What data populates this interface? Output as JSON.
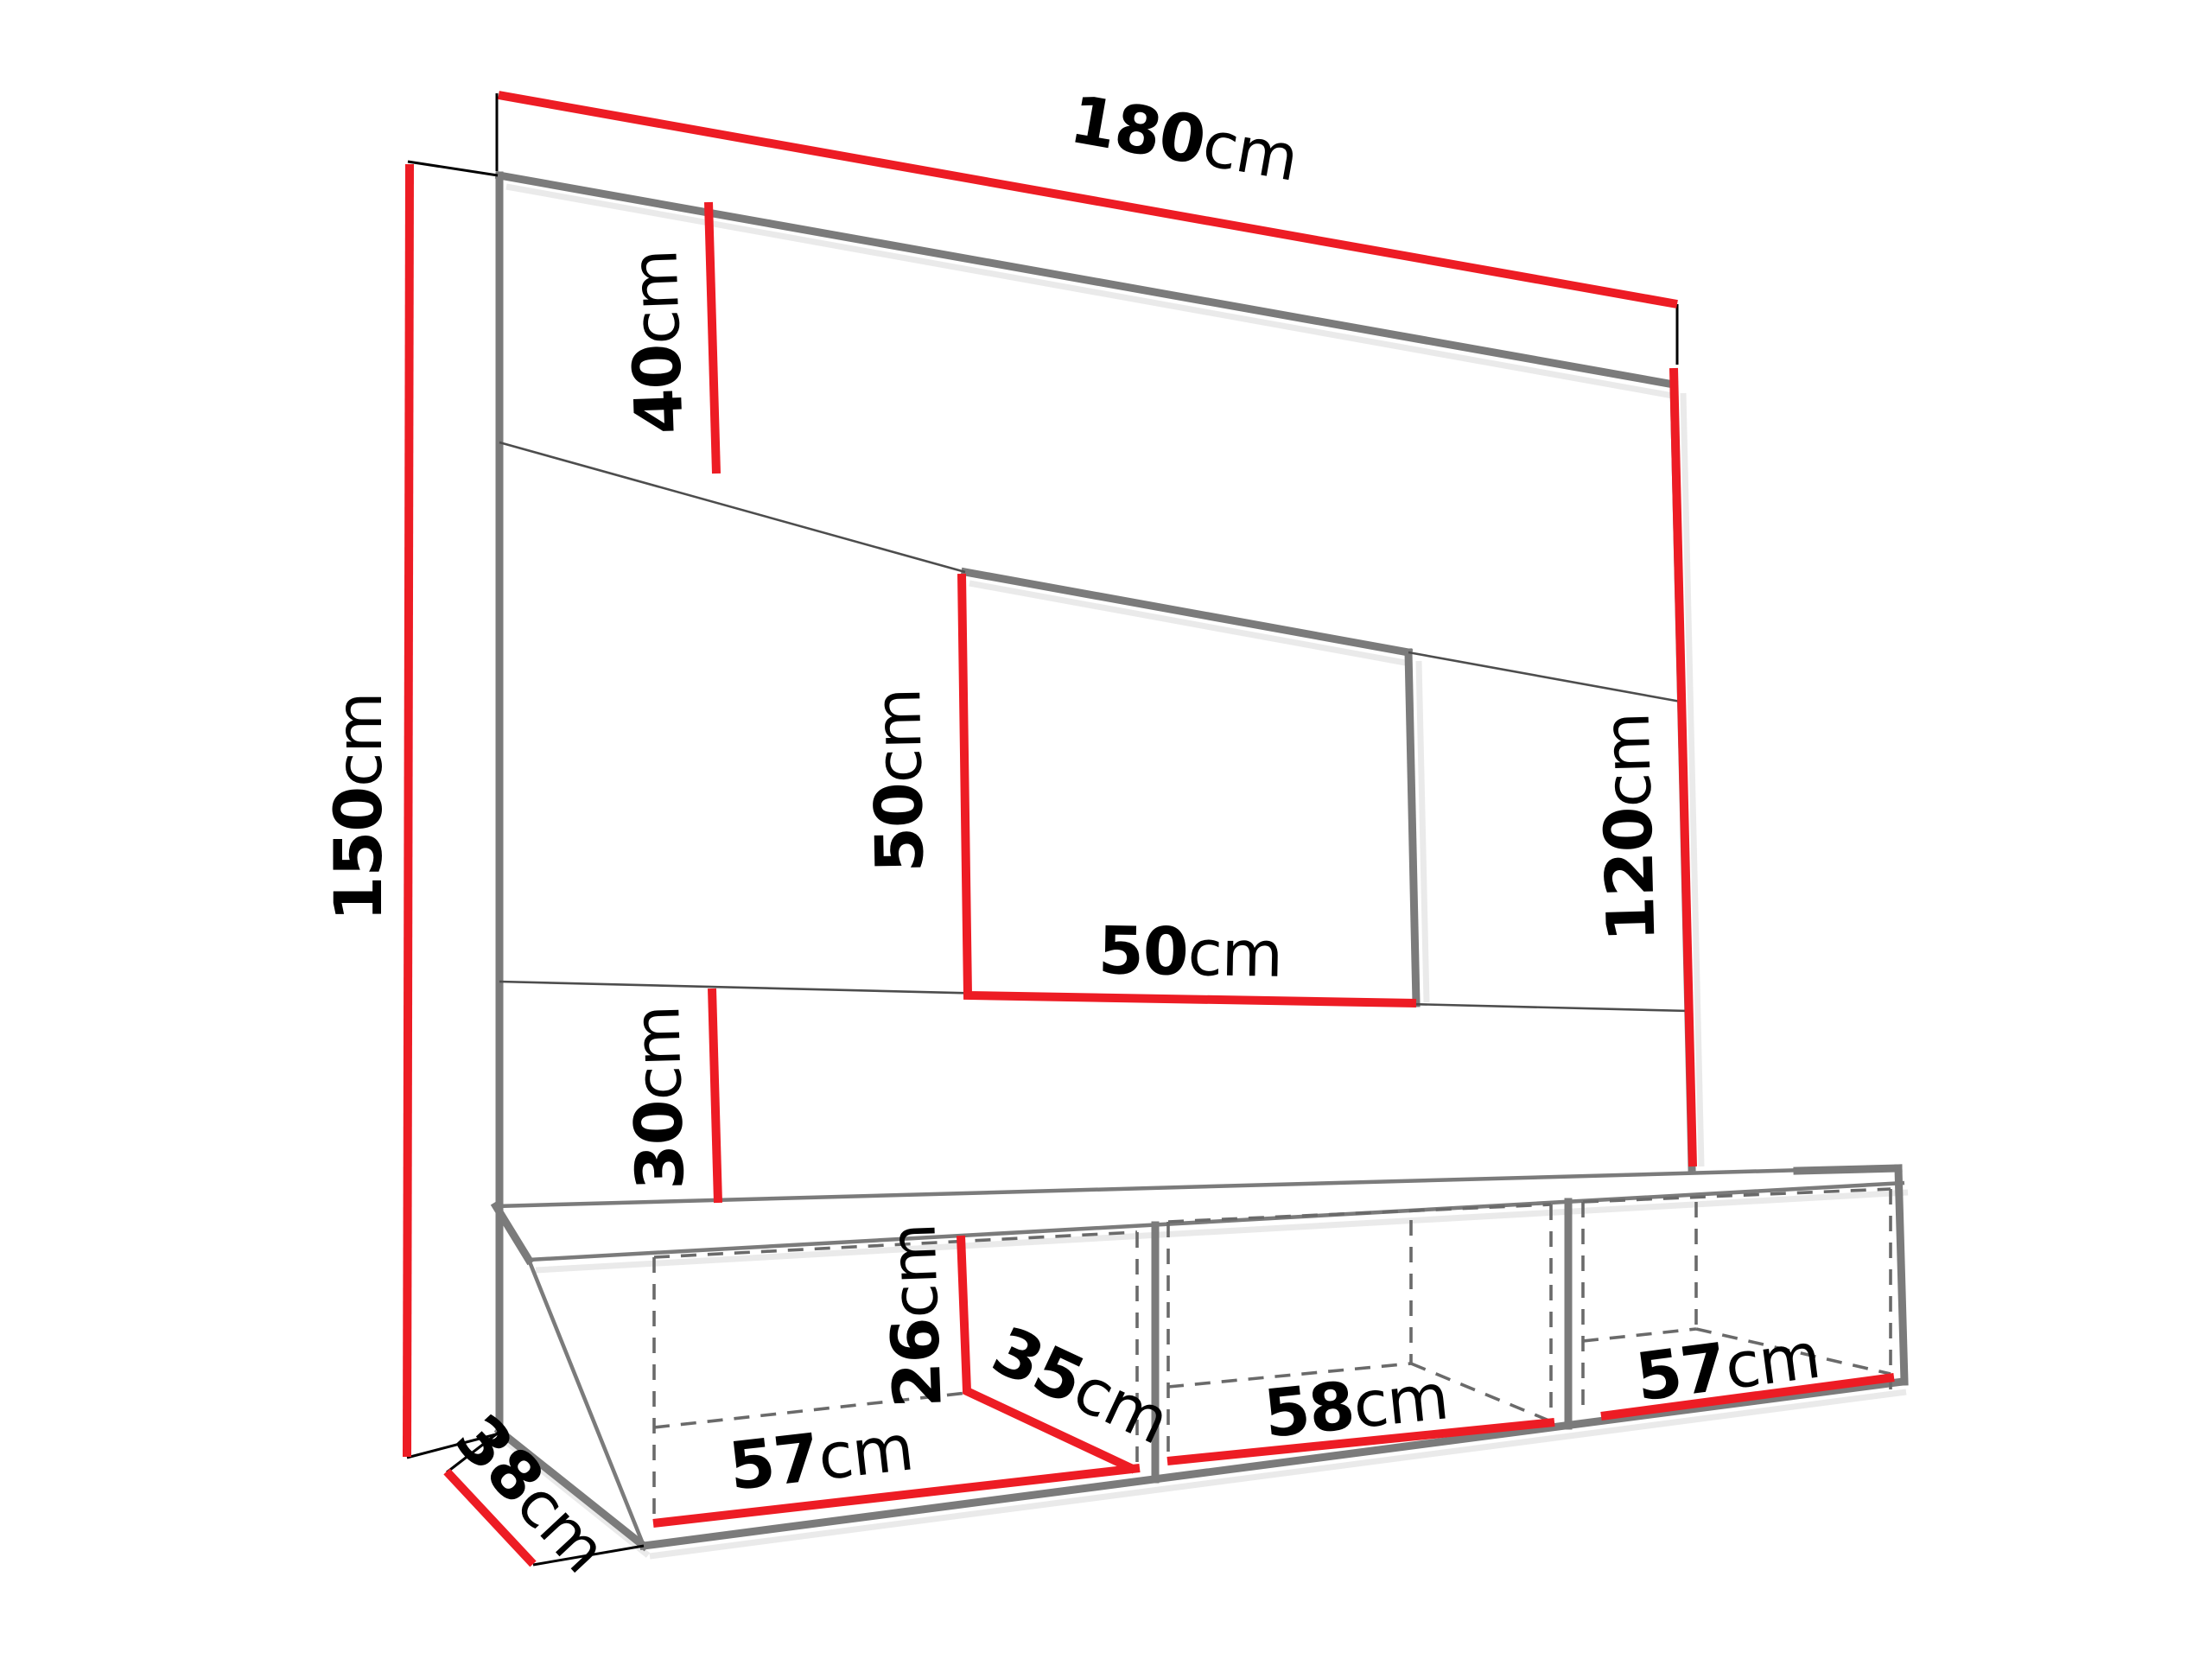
{
  "diagram": {
    "dimensions": {
      "d180": {
        "value": "180",
        "unit": "cm"
      },
      "d40": {
        "value": "40",
        "unit": "cm"
      },
      "d150": {
        "value": "150",
        "unit": "cm"
      },
      "d50v": {
        "value": "50",
        "unit": "cm"
      },
      "d50h": {
        "value": "50",
        "unit": "cm"
      },
      "d120": {
        "value": "120",
        "unit": "cm"
      },
      "d30": {
        "value": "30",
        "unit": "cm"
      },
      "d26": {
        "value": "26",
        "unit": "cm"
      },
      "d35": {
        "value": "35",
        "unit": "cm"
      },
      "d57a": {
        "value": "57",
        "unit": "cm"
      },
      "d58": {
        "value": "58",
        "unit": "cm"
      },
      "d57b": {
        "value": "57",
        "unit": "cm"
      },
      "d38": {
        "value": "38",
        "unit": "cm"
      }
    },
    "colors": {
      "dimension_red": "#ed1c24",
      "outline_gray": "#7b7b7b",
      "line_dark": "#4d4d4d",
      "dashed_gray": "#6a6a6a",
      "extension_black": "#000000",
      "shadow_gray": "#d9d9d9",
      "text_black": "#000000",
      "background": "#ffffff"
    }
  }
}
